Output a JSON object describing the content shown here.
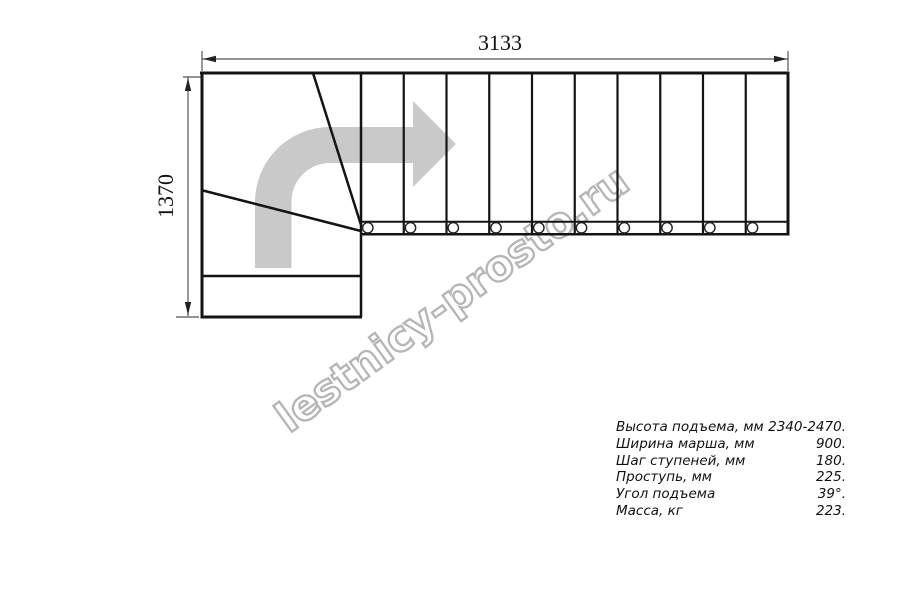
{
  "diagram": {
    "title": "L-shaped staircase plan (top view)",
    "top_dimension_label": "3133",
    "left_dimension_label": "1370",
    "watermark_text": "lestnicy-prosto.ru",
    "straight_steps_count": 10,
    "bolt_circles_count": 10
  },
  "colors": {
    "line": "#141414",
    "dimension_line": "#555555",
    "direction_arrow": "#c9c9c9",
    "watermark": "#b5b5b5",
    "background": "#ffffff"
  },
  "specs": {
    "rows": [
      {
        "label": "Высота подъема, мм",
        "value": "2340-2470."
      },
      {
        "label": "Ширина марша, мм",
        "value": "900."
      },
      {
        "label": "Шаг ступеней, мм",
        "value": "180."
      },
      {
        "label": "Проступь, мм",
        "value": "225."
      },
      {
        "label": "Угол подъема",
        "value": "39°."
      },
      {
        "label": "Масса, кг",
        "value": "223."
      }
    ]
  }
}
